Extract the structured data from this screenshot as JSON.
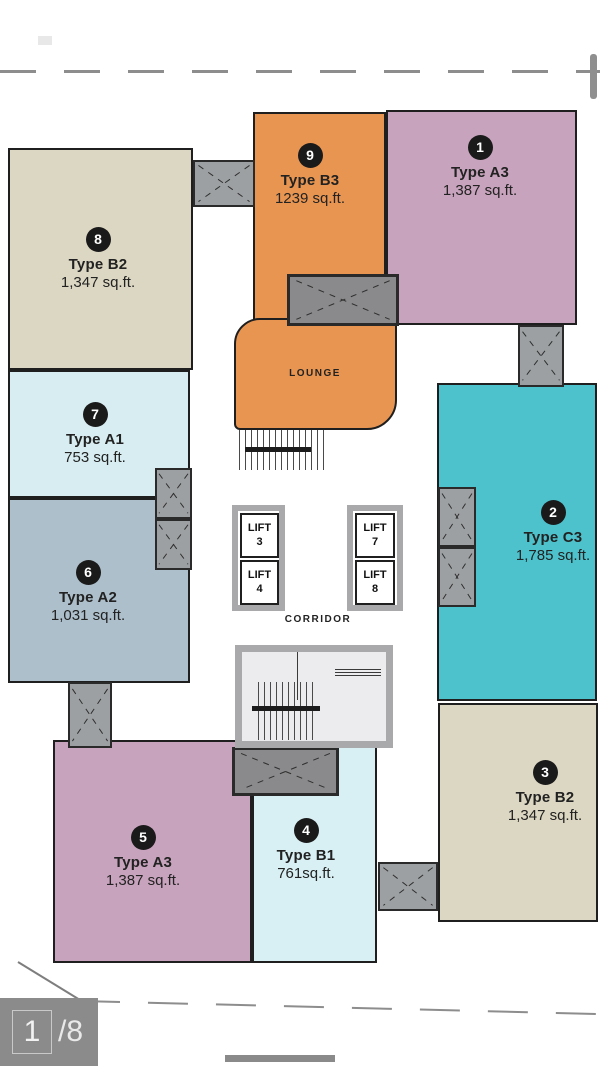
{
  "page": {
    "indicator": {
      "current": "1",
      "of_label": "/8"
    }
  },
  "plan": {
    "rooms": {
      "lounge": "LOUNGE",
      "corridor": "CORRIDOR"
    },
    "lifts": [
      {
        "label": "LIFT",
        "number": "3"
      },
      {
        "label": "LIFT",
        "number": "4"
      },
      {
        "label": "LIFT",
        "number": "7"
      },
      {
        "label": "LIFT",
        "number": "8"
      }
    ],
    "units": [
      {
        "number": "1",
        "type": "Type A3",
        "area": "1,387 sq.ft.",
        "color": "#c8a3bd"
      },
      {
        "number": "2",
        "type": "Type C3",
        "area": "1,785 sq.ft.",
        "color": "#4dc2cc"
      },
      {
        "number": "3",
        "type": "Type B2",
        "area": "1,347 sq.ft.",
        "color": "#dcd7c2"
      },
      {
        "number": "4",
        "type": "Type B1",
        "area": "761sq.ft.",
        "color": "#d8f0f3"
      },
      {
        "number": "5",
        "type": "Type A3",
        "area": "1,387 sq.ft.",
        "color": "#c8a3bd"
      },
      {
        "number": "6",
        "type": "Type A2",
        "area": "1,031 sq.ft.",
        "color": "#adbfcb"
      },
      {
        "number": "7",
        "type": "Type A1",
        "area": "753 sq.ft.",
        "color": "#d7edf1"
      },
      {
        "number": "8",
        "type": "Type B2",
        "area": "1,347 sq.ft.",
        "color": "#dcd7c2"
      },
      {
        "number": "9",
        "type": "Type B3",
        "area": "1239 sq.ft.",
        "color": "#e89551"
      }
    ],
    "lounge_color": "#e89551",
    "shaft_color": "#9da0a2",
    "wall_color": "#1f1f1f"
  }
}
